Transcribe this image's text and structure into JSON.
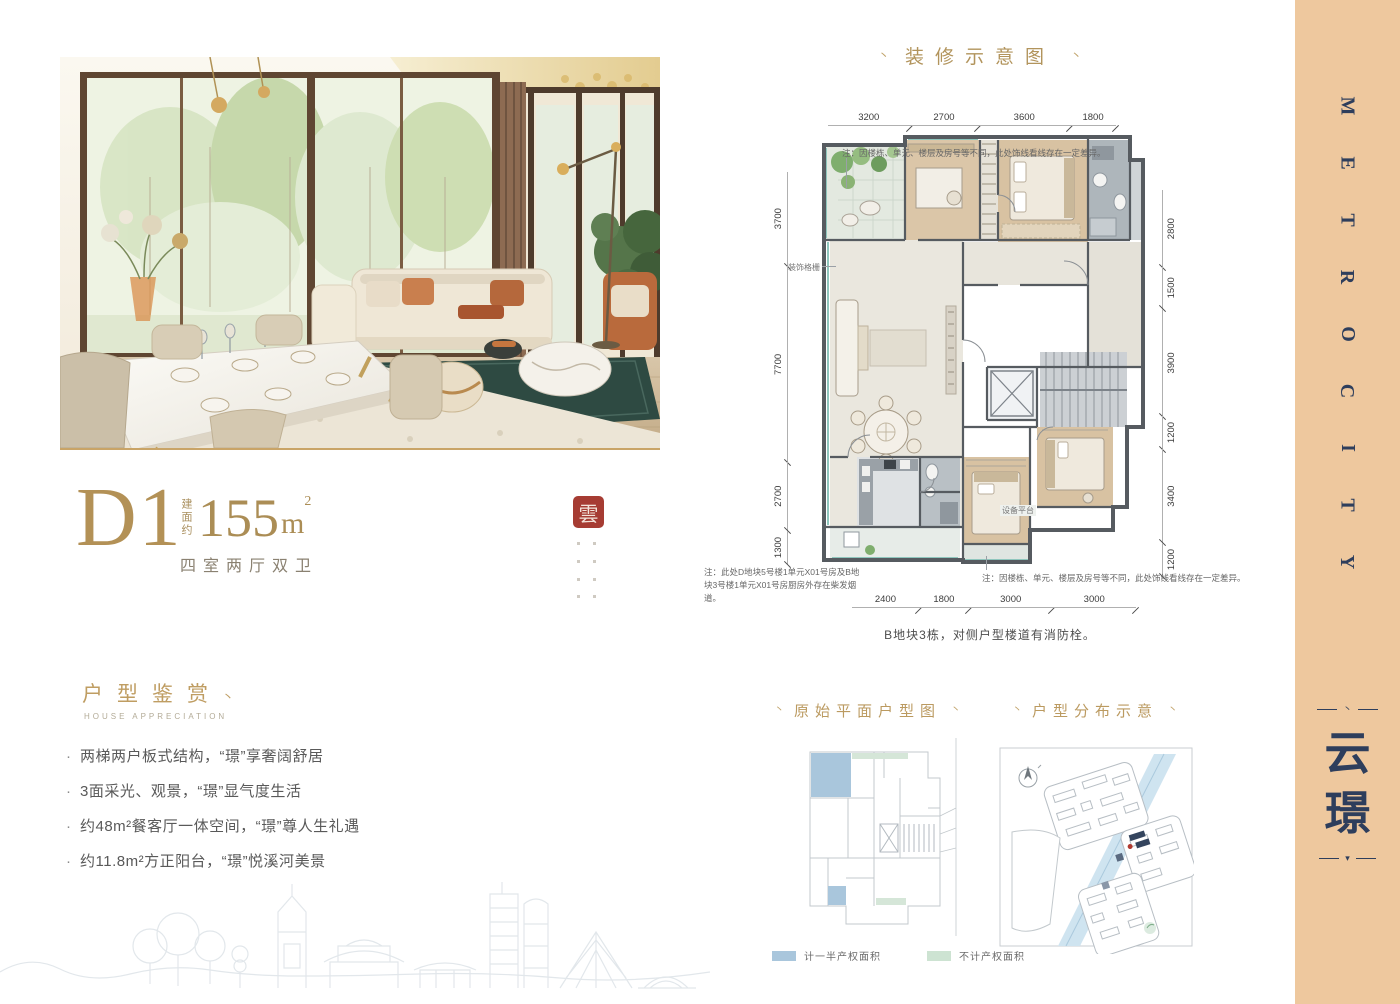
{
  "colors": {
    "accent_gold": "#b2945c",
    "brand_navy": "#2e3e5c",
    "sidebar_peach": "#eec89e",
    "seal_red": "#a63c33"
  },
  "deco": {
    "tick": "丶",
    "ornament_top": "丶",
    "ornament_bottom": "▾"
  },
  "unit": {
    "code": "D1",
    "area_prefix": "建面约",
    "area_value": "155",
    "area_unit": "m",
    "area_sup": "2",
    "layout_desc": "四室两厅双卫",
    "seal_char": "雲"
  },
  "appreciation": {
    "title": "户型鉴赏",
    "subtitle": "HOUSE APPRECIATION",
    "bullets": [
      "两梯两户板式结构，“璟”享奢阔舒居",
      "3面采光、观景，“璟”显气度生活",
      "约48m²餐客厅一体空间，“璟”尊人生礼遇",
      "约11.8m²方正阳台，“璟”悦溪河美景"
    ]
  },
  "plan": {
    "title": "装修示意图",
    "dims_top": [
      "3200",
      "2700",
      "3600",
      "1800"
    ],
    "dims_bottom": [
      "2400",
      "1800",
      "3000",
      "3000"
    ],
    "dims_left": [
      "3700",
      "7700",
      "2700",
      "1300"
    ],
    "dims_right": [
      "2800",
      "1500",
      "3900",
      "1200",
      "3400",
      "1200"
    ],
    "note_top": "注：因楼栋、单元、楼层及房号等不同，此处饰线看线存在一定差异。",
    "note_bottom_left": "注：此处D地块5号楼1单元X01号房及B地块3号楼1单元X01号房厨房外存在柴发烟道。",
    "note_bottom_right": "注：因楼栋、单元、楼层及房号等不同，此处饰线看线存在一定差异。",
    "caption": "B地块3栋，对侧户型楼道有消防栓。",
    "label_grille": "装饰格栅",
    "label_equipment": "设备平台"
  },
  "original_plan": {
    "title": "原始平面户型图"
  },
  "distribution": {
    "title": "户型分布示意"
  },
  "legend": [
    {
      "color": "#a9c6dc",
      "label": "计一半产权面积"
    },
    {
      "color": "#cde3d2",
      "label": "不计产权面积"
    }
  ],
  "sidebar": {
    "letters": [
      "M",
      "E",
      "T",
      "R",
      "O",
      "C",
      "I",
      "T",
      "Y"
    ],
    "cn_chars": [
      "云",
      "璟"
    ]
  }
}
